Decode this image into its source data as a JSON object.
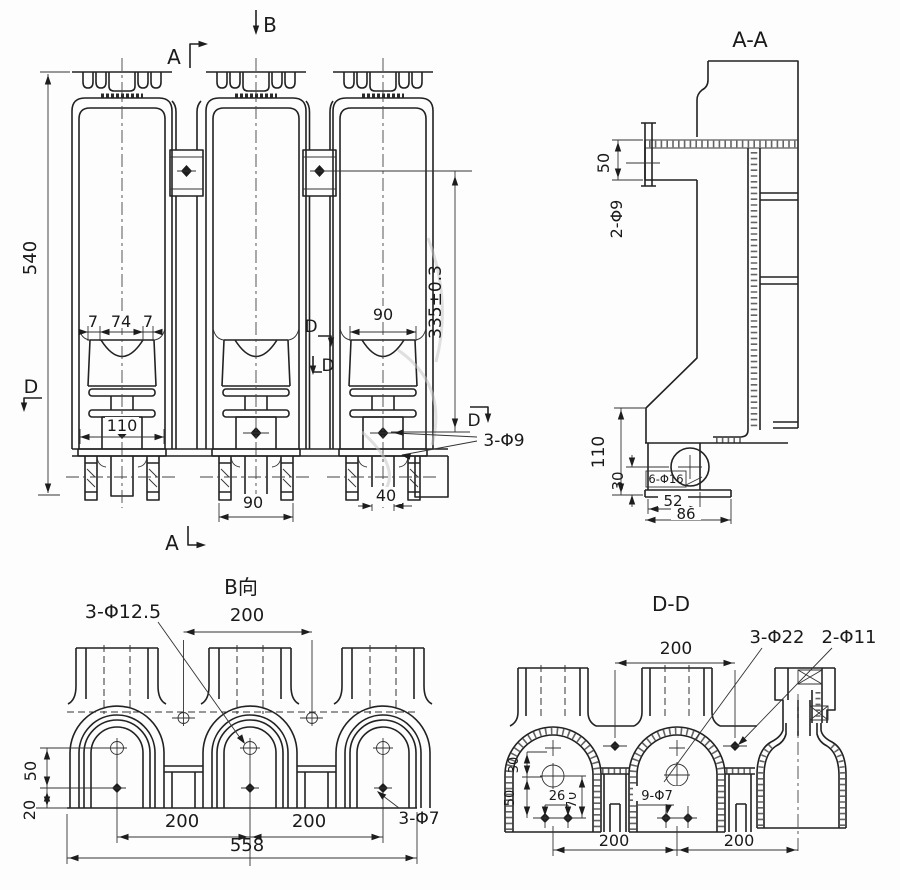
{
  "drawing": {
    "front": {
      "marker_b": "B",
      "marker_a_top": "A",
      "marker_a_bottom": "A",
      "marker_d_left": "D",
      "marker_d_mid_upper": "D",
      "marker_d_mid_lower": "D",
      "marker_d_right": "D",
      "dim_total_height": "540",
      "dim_rim_left": "7",
      "dim_rim_mid": "74",
      "dim_rim_right": "7",
      "dim_mount_width": "110",
      "dim_foot_width": "90",
      "dim_bell_width": "90",
      "dim_stem_width": "40",
      "dim_hole_height": "335±0.3",
      "label_holes": "3-Φ9"
    },
    "section_aa": {
      "title": "A-A",
      "dim_plate": "50",
      "label_holes_plate": "2-Φ9",
      "dim_foot_height": "110",
      "dim_hole_height": "30",
      "label_holes_foot": "6-Φ16",
      "dim_foot_52": "52",
      "dim_foot_86": "86"
    },
    "view_b": {
      "title": "B向",
      "label_holes_top": "3-Φ12.5",
      "dim_top_span": "200",
      "dim_hole_50": "50",
      "dim_hole_20": "20",
      "dim_span_left": "200",
      "dim_span_right": "200",
      "dim_total_width": "558",
      "label_holes_bottom": "3-Φ7"
    },
    "section_dd": {
      "title": "D-D",
      "dim_top_span": "200",
      "label_holes_large": "3-Φ22",
      "label_holes_web": "2-Φ11",
      "dim_30": "30",
      "dim_50": "50",
      "dim_26": "26",
      "dim_70": "70",
      "label_holes_small": "9-Φ7",
      "dim_span_left": "200",
      "dim_span_right": "200"
    }
  }
}
